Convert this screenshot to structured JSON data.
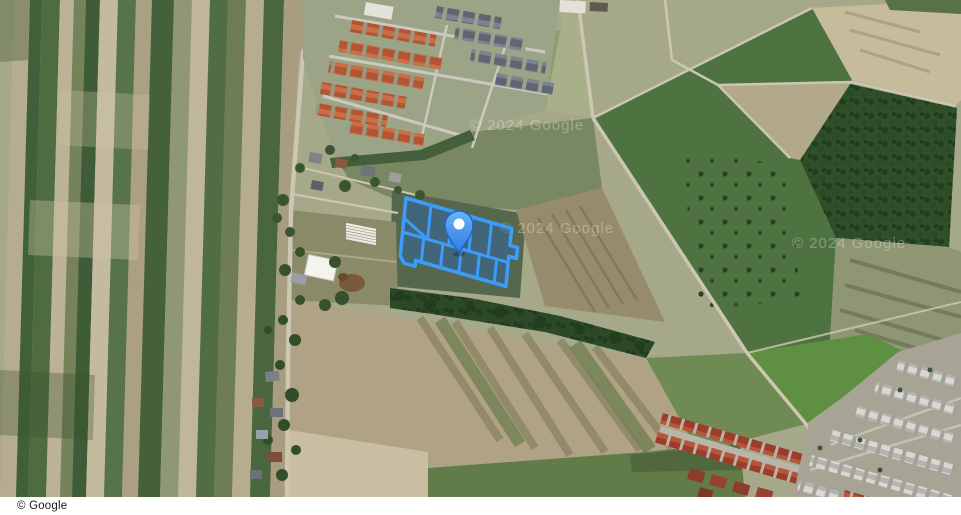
{
  "map": {
    "attribution": "© Google",
    "watermarks": [
      {
        "text": "© 2024 Google",
        "x": 470,
        "y": 130
      },
      {
        "text": "© 2024 Google",
        "x": 500,
        "y": 233
      },
      {
        "text": "© 2024 Google",
        "x": 792,
        "y": 248
      }
    ],
    "overlay": {
      "parcel_stroke": "#3d9bfa",
      "parcel_fill": "rgba(28,100,205,0.35)",
      "pin": {
        "fill_top": "#6ab2fc",
        "fill_bottom": "#2e7cdf",
        "stroke": "#2166c6",
        "dot": "#ffffff"
      }
    },
    "palette": {
      "field_green_dark": "#3d5c37",
      "field_green": "#4e7340",
      "field_tan": "#b3a586",
      "forest": "#2f4f29",
      "road": "#ccc6b2",
      "roof_orange": "#b35434",
      "roof_red": "#9c3d2c",
      "roof_gray": "#5d6671"
    }
  }
}
